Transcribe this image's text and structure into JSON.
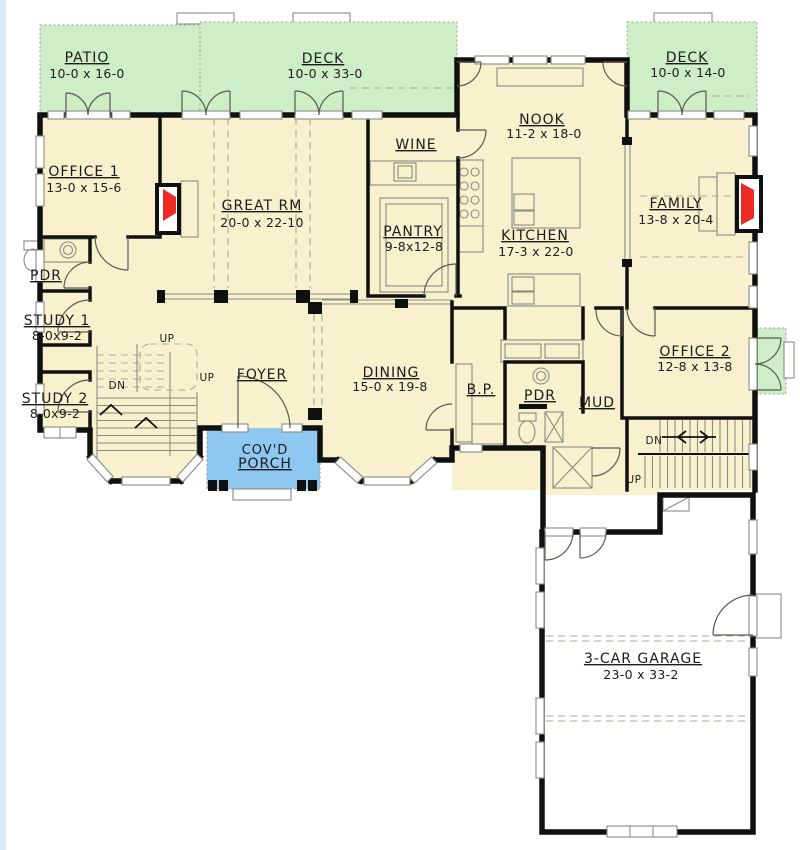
{
  "colors": {
    "floor": "#f8f1cd",
    "deck": "#cdeec6",
    "porch": "#8ec7f0",
    "fireplace": "#ee2b23",
    "walls": "#101010",
    "page_edge": "#d9eaf6"
  },
  "rooms": {
    "patio": {
      "name": "PATIO",
      "dims": "10-0 x 16-0"
    },
    "deck_main": {
      "name": "DECK",
      "dims": "10-0 x 33-0"
    },
    "deck_right": {
      "name": "DECK",
      "dims": "10-0 x 14-0"
    },
    "office1": {
      "name": "OFFICE 1",
      "dims": "13-0 x 15-6"
    },
    "great_room": {
      "name": "GREAT RM",
      "dims": "20-0 x 22-10"
    },
    "wine": {
      "name": "WINE"
    },
    "nook": {
      "name": "NOOK",
      "dims": "11-2 x 18-0"
    },
    "family": {
      "name": "FAMILY",
      "dims": "13-8 x 20-4"
    },
    "powder1": {
      "name": "PDR"
    },
    "pantry": {
      "name": "PANTRY",
      "dims": "9-8x12-8"
    },
    "kitchen": {
      "name": "KITCHEN",
      "dims": "17-3 x 22-0"
    },
    "study1": {
      "name": "STUDY 1",
      "dims": "8-0x9-2"
    },
    "study2": {
      "name": "STUDY 2",
      "dims": "8-0x9-2"
    },
    "foyer": {
      "name": "FOYER"
    },
    "dining": {
      "name": "DINING",
      "dims": "15-0 x 19-8"
    },
    "butlers_pantry": {
      "name": "B.P."
    },
    "powder2": {
      "name": "PDR"
    },
    "mud": {
      "name": "MUD"
    },
    "office2": {
      "name": "OFFICE 2",
      "dims": "12-8 x 13-8"
    },
    "covered_porch": {
      "name_line1": "COV'D",
      "name_line2": "PORCH"
    },
    "garage": {
      "name": "3-CAR GARAGE",
      "dims": "23-0 x 33-2"
    }
  },
  "stairs": {
    "up": "UP",
    "dn": "DN"
  }
}
